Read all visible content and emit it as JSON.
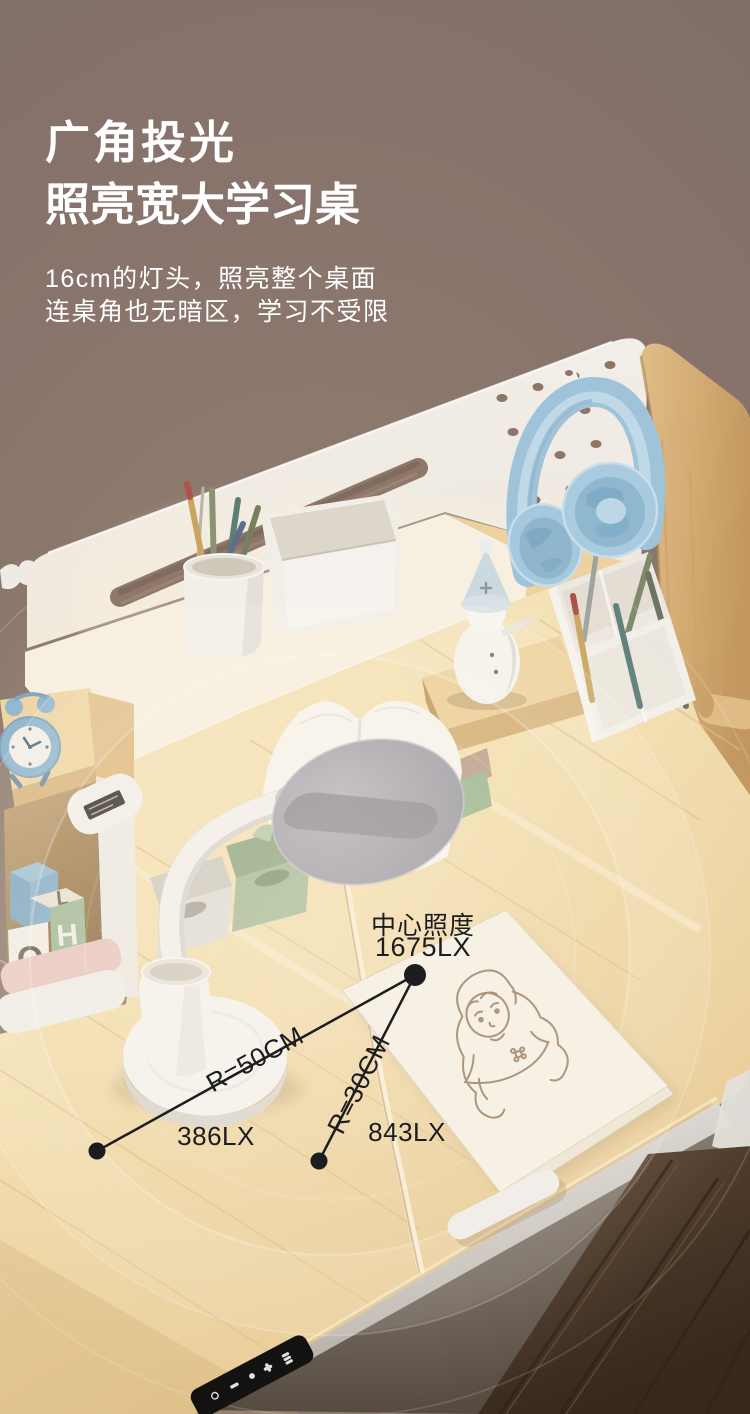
{
  "canvas": {
    "width": 750,
    "height": 1414
  },
  "colors": {
    "background": "#87736B",
    "heading_text": "#FFFFFF",
    "annotation": "#1C1C1E",
    "wood": "#F2DEB2",
    "wood_dark": "#D8B57E",
    "panel": "#F1EDE7",
    "cream": "#F7EFDF",
    "headphones": "#A6C9DD",
    "lamp_head": "#A8A6AE",
    "lamp_body": "#F4F2EE",
    "clock": "#8FB5CE",
    "green_box": "#A5BA97",
    "snowman_hat": "#CCD9DF",
    "paper": "#F6F1E4",
    "floor": "#4C382A"
  },
  "header": {
    "title_line1": "广角投光",
    "title_line2": "照亮宽大学习桌",
    "subtitle_line1": "16cm的灯头，照亮整个桌面",
    "subtitle_line2": "连桌角也无暗区，学习不受限"
  },
  "annotations": {
    "center": {
      "label": "中心照度",
      "value": "1675LX"
    },
    "radius_50cm": {
      "label": "R=50CM",
      "illuminance": "386LX"
    },
    "radius_30cm": {
      "label": "R=30CM",
      "illuminance": "843LX"
    }
  },
  "scene": {
    "block_letters": [
      "O",
      "L",
      "H"
    ]
  }
}
